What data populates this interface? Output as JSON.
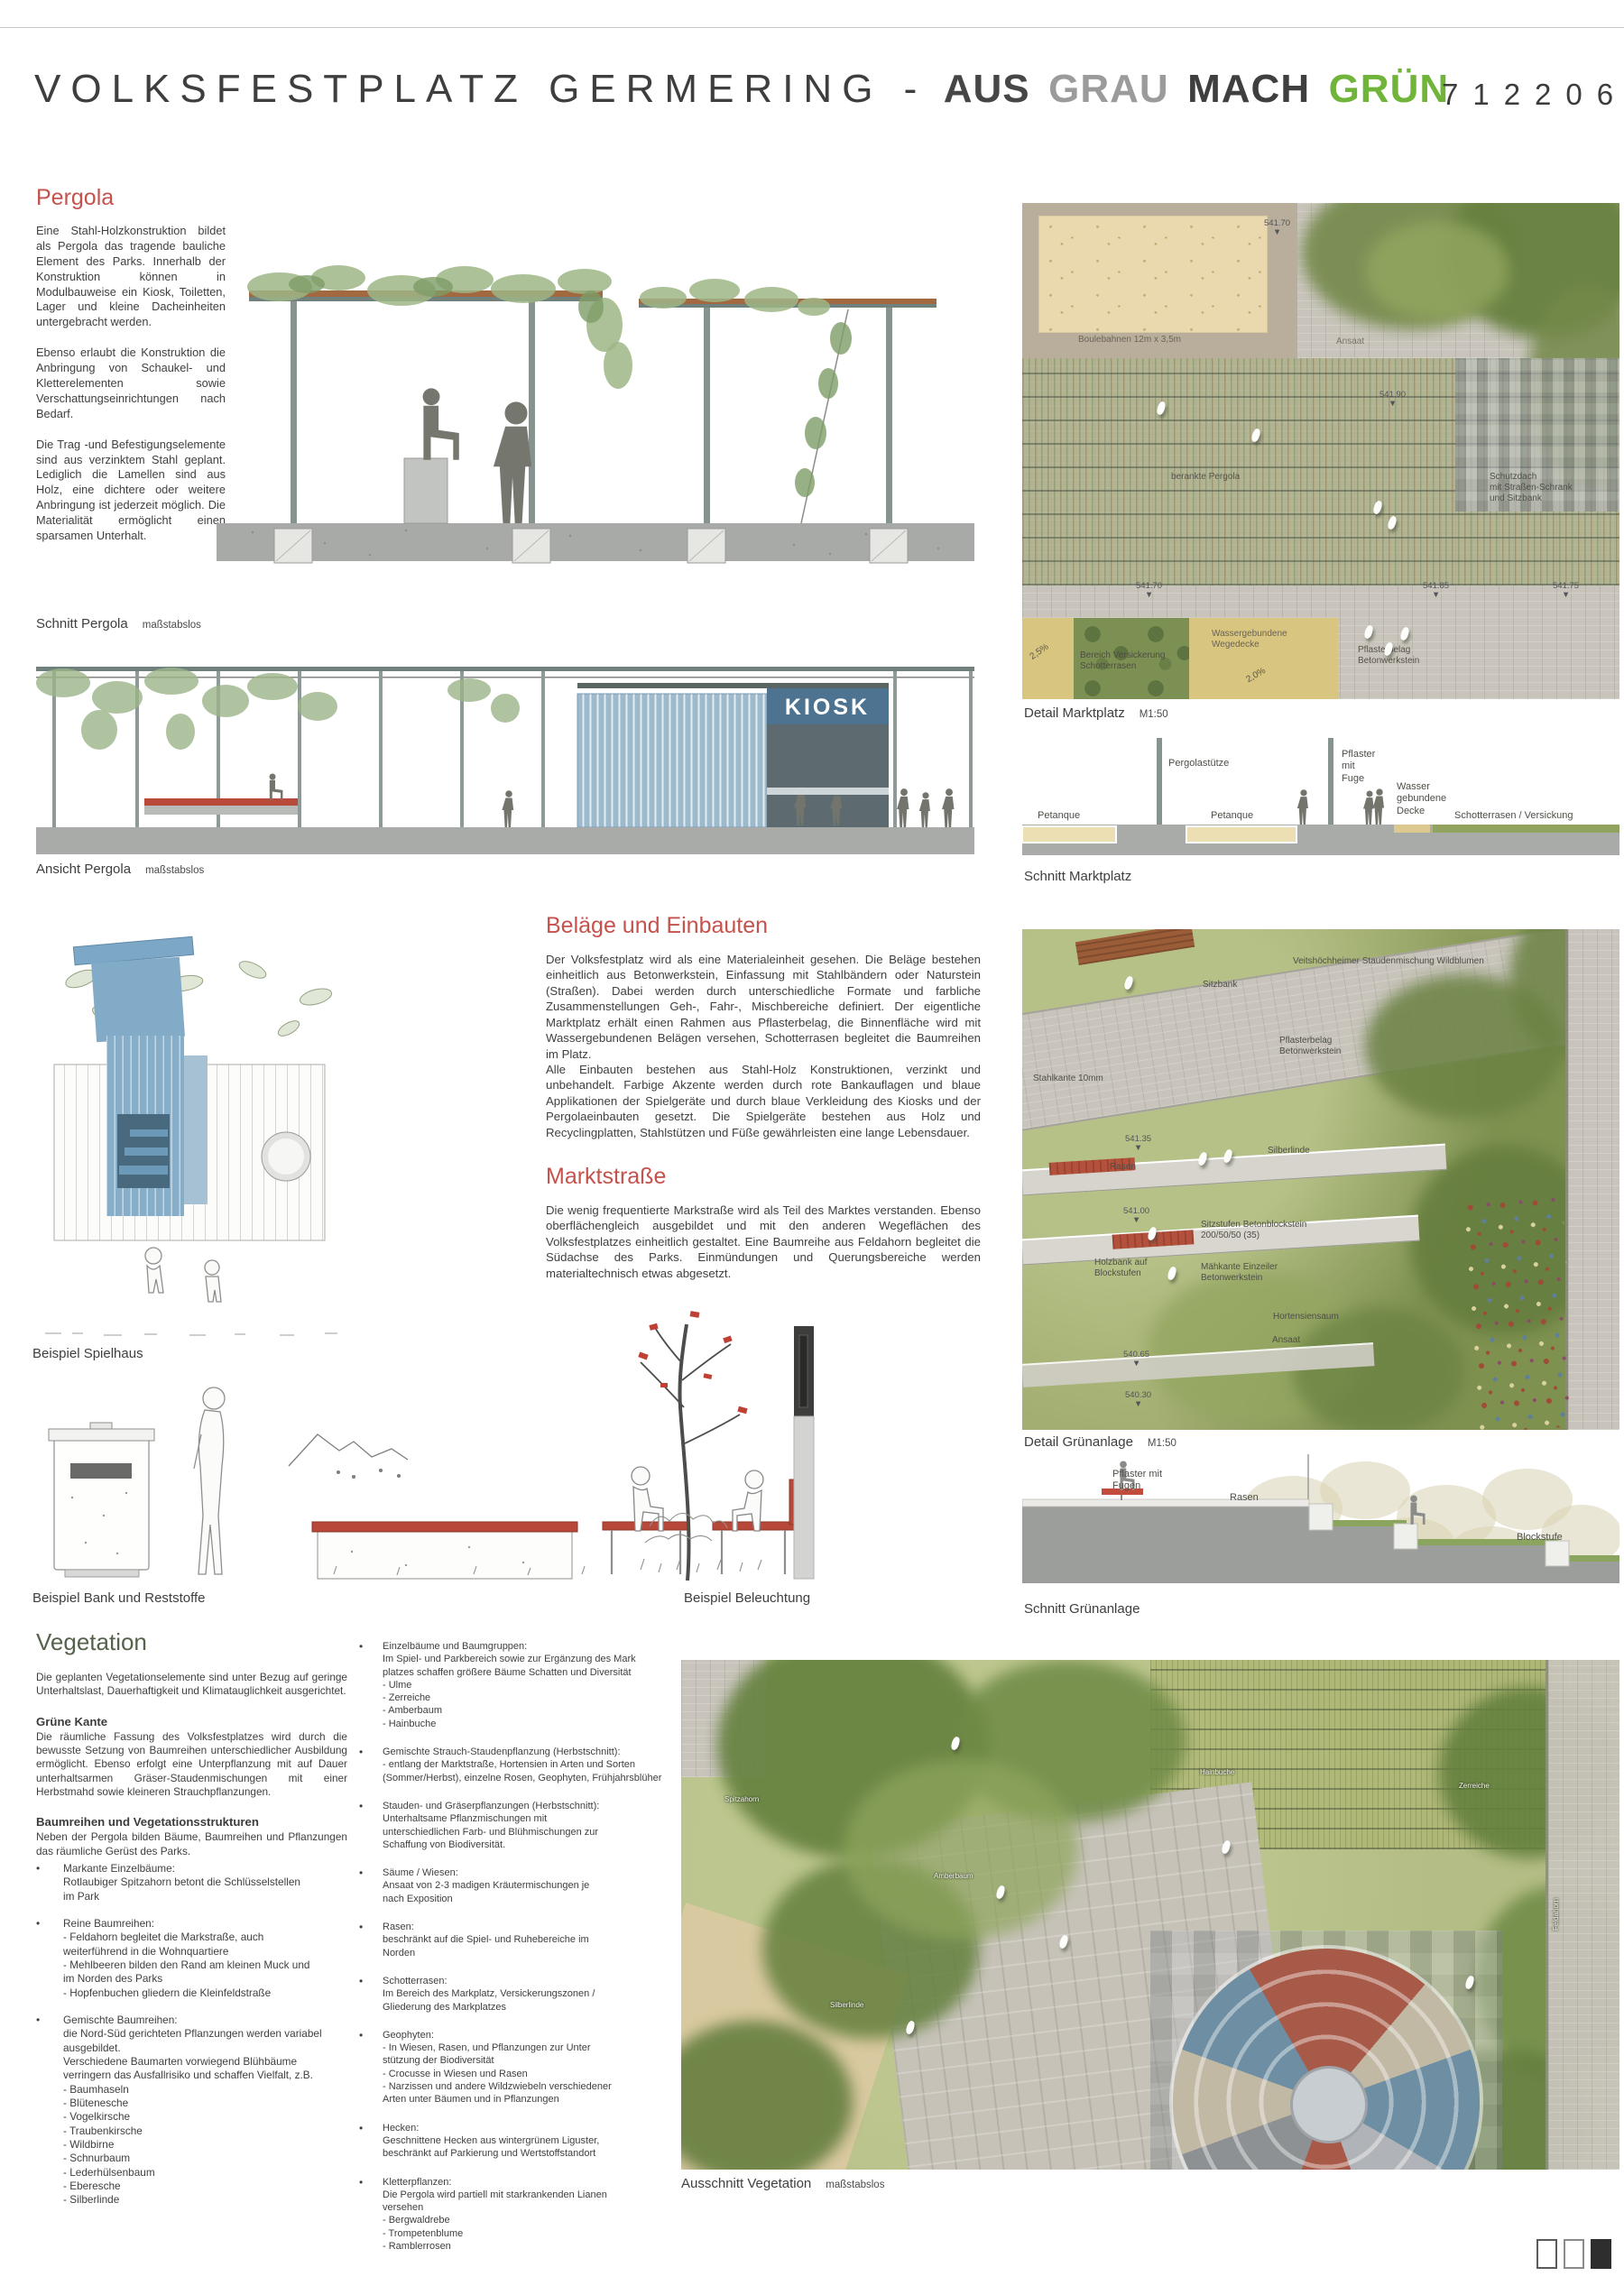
{
  "header": {
    "title_main": "VOLKSFESTPLATZ GERMERING -",
    "title_aus": "AUS",
    "title_grau": "GRAU",
    "title_mach": "MACH",
    "title_gruen": "GRÜN",
    "project_number": "712206",
    "accent_green": "#70b43a",
    "accent_red": "#c5524c"
  },
  "pergola": {
    "heading": "Pergola",
    "p1": "Eine Stahl-Holzkonstruktion bildet als Pergola das tragende bauliche Element des Parks. Innerhalb der Konstruktion können in Modulbauweise ein Kiosk, Toiletten, Lager und kleine Dacheinheiten untergebracht werden.",
    "p2": "Ebenso erlaubt die Konstruktion die Anbringung von Schaukel- und Kletterelementen sowie Verschattungseinrichtungen nach Bedarf.",
    "p3": "Die Trag -und Befestigungselemente sind aus verzinktem Stahl geplant. Lediglich die Lamellen sind aus Holz, eine dichtere oder weitere Anbringung ist jederzeit möglich. Die Materialität ermöglicht einen sparsamen Unterhalt.",
    "kiosk_sign": "KIOSK"
  },
  "belaege": {
    "heading": "Beläge und Einbauten",
    "p1": "Der Volksfestplatz wird als eine Materialeinheit gesehen. Die Beläge bestehen einheitlich aus Betonwerkstein, Einfassung mit Stahlbändern oder Naturstein (Straßen). Dabei werden durch unterschiedliche Formate und farbliche Zusammenstellungen Geh-, Fahr-, Mischbereiche definiert. Der eigentliche Marktplatz erhält einen Rahmen aus Pflasterbelag, die Binnenfläche wird mit Wassergebundenen Belägen versehen, Schotterrasen begleitet die Baumreihen im Platz.",
    "p2": "Alle Einbauten bestehen aus Stahl-Holz Konstruktionen, verzinkt und unbehandelt. Farbige Akzente werden durch rote Bankauflagen und blaue Applikationen der Spielgeräte und durch blaue Verkleidung des Kiosks und der Pergolaeinbauten gesetzt. Die Spielgeräte bestehen aus Holz und Recyclingplatten, Stahlstützen und Füße gewährleisten eine lange Lebensdauer."
  },
  "marktstrasse": {
    "heading": "Marktstraße",
    "p1": "Die wenig frequentierte Markstraße wird als Teil des Marktes verstanden. Ebenso oberflächengleich ausgebildet und mit den anderen Wegeflächen des Volksfestplatzes einheitlich gestaltet. Eine Baumreihe aus Feldahorn begleitet die Südachse des Parks. Einmündungen und Querungsbereiche werden materialtechnisch etwas abgesetzt."
  },
  "captions": {
    "schnitt_pergola": "Schnitt Pergola",
    "schnitt_pergola_scale": "maßstabslos",
    "ansicht_pergola": "Ansicht Pergola",
    "ansicht_pergola_scale": "maßstabslos",
    "detail_marktplatz": "Detail Marktplatz",
    "detail_marktplatz_scale": "M1:50",
    "schnitt_marktplatz": "Schnitt Marktplatz",
    "beispiel_spielhaus": "Beispiel Spielhaus",
    "beispiel_bank": "Beispiel Bank und Reststoffe",
    "beispiel_beleuchtung": "Beispiel Beleuchtung",
    "detail_gruenanlage": "Detail Grünanlage",
    "detail_gruenanlage_scale": "M1:50",
    "schnitt_gruenanlage": "Schnitt Grünanlage",
    "ausschnitt_vegetation": "Ausschnitt Vegetation",
    "ausschnitt_vegetation_scale": "maßstabslos"
  },
  "marktplatz_plan": {
    "boulebahnen": "Boulebahnen 12m x 3,5m",
    "elev_top": "541.70\n▼",
    "ansaat": "Ansaat",
    "berankte": "berankte Pergola",
    "elev_mid": "541.90\n▼",
    "schutzdach": "Schutzdach\nmit Straßen-Schrank\nund Sitzbank",
    "elev_a": "541.70\n▼",
    "elev_b": "541.85\n▼",
    "elev_c": "541.75\n▼",
    "slope_a": "2,5%",
    "versickerung": "Bereich Versickerung\nSchotterrasen",
    "wegedecke": "Wassergebundene\nWegedecke",
    "slope_b": "2,0%",
    "pflasterbelag": "Pflasterbelag\nBetonwerkstein"
  },
  "marktplatz_schnitt": {
    "petanque_a": "Petanque",
    "petanque_b": "Petanque",
    "pergolastuetze": "Pergolastütze",
    "pflaster": "Pflaster\nmit\nFuge",
    "wasser": "Wasser\ngebundene\nDecke",
    "schotterrasen": "Schotterrasen / Versickung"
  },
  "gruenanlage_plan": {
    "staudenmischung": "Veitshöchheimer Staudenmischung Wildblumen",
    "sitzbank": "Sitzbank",
    "pflasterbelag": "Pflasterbelag\nBetonwerkstein",
    "stahlkante": "Stahlkante 10mm",
    "silberlinde": "Silberlinde",
    "rasen": "Rasen",
    "elev_a": "541.35\n▼",
    "elev_b": "541.00\n▼",
    "sitzstufen": "Sitzstufen Betonblockstein\n200/50/50 (35)",
    "holzbank": "Holzbank auf\nBlockstufen",
    "maehkante": "Mähkante Einzeiler\nBetonwerkstein",
    "hortensiensaum": "Hortensiensaum",
    "ansaat": "Ansaat",
    "elev_c": "540.65\n▼",
    "elev_d": "540.30\n▼"
  },
  "gruenanlage_schnitt": {
    "pflaster": "Pflaster mit\nFugen",
    "rasen": "Rasen",
    "blockstufe": "Blockstufe"
  },
  "vegetation": {
    "heading": "Vegetation",
    "intro": "Die geplanten Vegetationselemente sind unter Bezug auf geringe Unterhaltslast, Dauerhaftigkeit und Klimatauglichkeit ausgerichtet.",
    "sub1": "Grüne Kante",
    "sub1_text": "Die räumliche Fassung des Volksfestplatzes wird durch die bewusste Setzung von Baumreihen unterschiedlicher Ausbildung ermöglicht. Ebenso erfolgt eine Unterpflanzung mit auf Dauer unterhaltsarmen Gräser-Staudenmischungen mit einer Herbstmahd sowie kleineren Strauchpflanzungen.",
    "sub2": "Baumreihen und Vegetationsstrukturen",
    "sub2_text": "Neben der Pergola bilden Bäume, Baumreihen und Pflanzungen das räumliche Gerüst des Parks.",
    "col1": [
      {
        "title": "Markante Einzelbäume:",
        "lines": "Rotlaubiger Spitzahorn betont die Schlüsselstellen\nim Park"
      },
      {
        "title": "Reine Baumreihen:",
        "lines": "- Feldahorn begleitet die Markstraße, auch\nweiterführend in die Wohnquartiere\n- Mehlbeeren bilden den Rand am kleinen Muck und\nim Norden des Parks\n- Hopfenbuchen gliedern die Kleinfeldstraße"
      },
      {
        "title": "Gemischte Baumreihen:",
        "lines": "die Nord-Süd gerichteten Pflanzungen werden variabel\nausgebildet.\nVerschiedene Baumarten vorwiegend Blühbäume\nverringern das Ausfallrisiko und schaffen Vielfalt, z.B.\n- Baumhaseln\n- Blütenesche\n- Vogelkirsche\n- Traubenkirsche\n- Wildbirne\n- Schnurbaum\n- Lederhülsenbaum\n- Eberesche\n- Silberlinde"
      }
    ],
    "col2": [
      {
        "title": "Einzelbäume und Baumgruppen:",
        "lines": "Im Spiel- und Parkbereich sowie zur Ergänzung des Mark\nplatzes schaffen größere Bäume Schatten und Diversität\n- Ulme\n- Zerreiche\n- Amberbaum\n- Hainbuche"
      },
      {
        "title": "Gemischte Strauch-Staudenpflanzung (Herbstschnitt):",
        "lines": "- entlang der Marktstraße, Hortensien in Arten und Sorten\n(Sommer/Herbst), einzelne Rosen, Geophyten, Frühjahrsblüher"
      },
      {
        "title": "Stauden- und Gräserpflanzungen (Herbstschnitt):",
        "lines": "Unterhaltsame Pflanzmischungen mit\nunterschiedlichen Farb- und Blühmischungen zur\nSchaffung von Biodiversität."
      },
      {
        "title": "Säume / Wiesen:",
        "lines": "Ansaat von 2-3 madigen Kräutermischungen je\nnach Exposition"
      },
      {
        "title": "Rasen:",
        "lines": "beschränkt auf die Spiel- und Ruhebereiche im\nNorden"
      },
      {
        "title": "Schotterrasen:",
        "lines": "Im Bereich des Markplatz, Versickerungszonen /\nGliederung des Markplatzes"
      },
      {
        "title": "Geophyten:",
        "lines": "- In Wiesen, Rasen, und Pflanzungen zur Unter\nstützung der Biodiversität\n- Crocusse in Wiesen und Rasen\n- Narzissen und andere Wildzwiebeln verschiedener\nArten unter Bäumen und in Pflanzungen"
      },
      {
        "title": "Hecken:",
        "lines": "Geschnittene Hecken aus wintergrünem Liguster,\nbeschränkt auf Parkierung und Wertstoffstandort"
      },
      {
        "title": "Kletterpflanzen:",
        "lines": "Die Pergola wird partiell mit starkrankenden Lianen\nversehen\n- Bergwaldrebe\n- Trompetenblume\n- Ramblerrosen"
      }
    ]
  },
  "ausschnitt_tags": [
    "Spitzahorn",
    "Amberbaum",
    "Silberlinde",
    "Hainbuche",
    "Zerreiche",
    "Feldahorn"
  ]
}
